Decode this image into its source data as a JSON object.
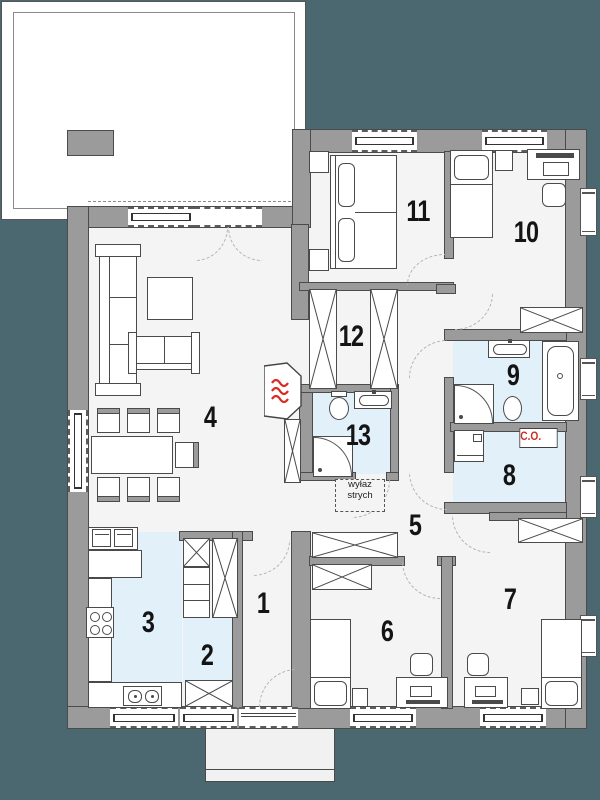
{
  "title": "house floor plan",
  "rooms": {
    "r1": "1",
    "r2": "2",
    "r3": "3",
    "r4": "4",
    "r5": "5",
    "r6": "6",
    "r7": "7",
    "r8": "8",
    "r9": "9",
    "r10": "10",
    "r11": "11",
    "r12": "12",
    "r13": "13"
  },
  "labels": {
    "boiler": "C.O.",
    "attic_line1": "wyłaz",
    "attic_line2": "strych"
  },
  "colors": {
    "background": "#4B6770",
    "wall": "#9B9B9B",
    "wall_outline": "#4B4B4B",
    "floor": "#F4F4F4",
    "wet_room_fill": "#E2F0FA",
    "accent_red": "#CF2E24",
    "terrace_fill": "#FFFFFF"
  }
}
